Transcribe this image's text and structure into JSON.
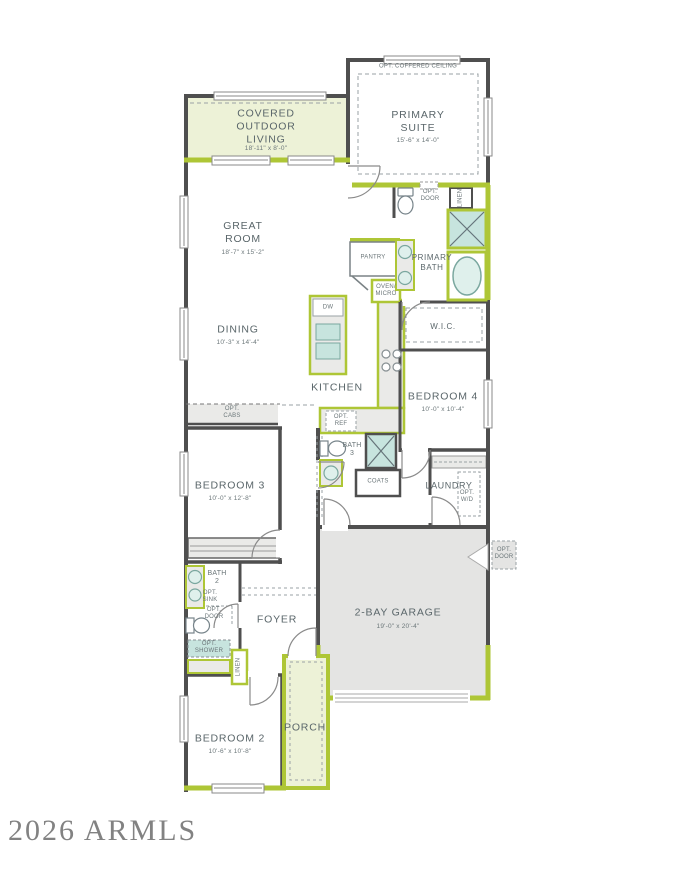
{
  "watermark": "2026 ARMLS",
  "colors": {
    "wall": "#4f4f4f",
    "accent_lime": "#aec636",
    "room_tint_green": "#edf2d7",
    "fixture_teal": "#c7e4de",
    "garage_fill": "#e4e4e3",
    "counter_fill": "#eaeae8",
    "label_text": "#5a666a",
    "watermark_text": "#828282"
  },
  "rooms": {
    "covered_outdoor_living": {
      "name": "COVERED\nOUTDOOR\nLIVING",
      "dims": "18'-11\" x 8'-0\""
    },
    "primary_suite": {
      "name": "PRIMARY\nSUITE",
      "dims": "15'-6\" x 14'-0\"",
      "option": "OPT. COFFERED CEILING"
    },
    "great_room": {
      "name": "GREAT\nROOM",
      "dims": "18'-7\" x 15'-2\""
    },
    "dining": {
      "name": "DINING",
      "dims": "10'-3\" x 14'-4\""
    },
    "kitchen": {
      "name": "KITCHEN"
    },
    "pantry": {
      "name": "PANTRY"
    },
    "primary_bath": {
      "name": "PRIMARY\nBATH"
    },
    "linen_primary": {
      "name": "LINEN"
    },
    "wic": {
      "name": "W.I.C."
    },
    "bedroom_4": {
      "name": "BEDROOM 4",
      "dims": "10'-0\" x 10'-4\""
    },
    "bath_3": {
      "name": "BATH\n3"
    },
    "coats": {
      "name": "COATS"
    },
    "laundry": {
      "name": "LAUNDRY"
    },
    "bedroom_3": {
      "name": "BEDROOM 3",
      "dims": "10'-0\" x 12'-8\""
    },
    "bath_2": {
      "name": "BATH\n2"
    },
    "linen_hall": {
      "name": "LINEN"
    },
    "foyer": {
      "name": "FOYER"
    },
    "garage": {
      "name": "2-BAY GARAGE",
      "dims": "19'-0\" x 20'-4\""
    },
    "bedroom_2": {
      "name": "BEDROOM 2",
      "dims": "10'-6\" x 10'-8\""
    },
    "porch": {
      "name": "PORCH"
    }
  },
  "annotations": {
    "opt_door_primary": "OPT.\nDOOR",
    "oven_micro": "OVEN/\nMICRO",
    "dw": "DW",
    "opt_cabs": "OPT.\nCABS",
    "opt_ref": "OPT.\nREF",
    "opt_wd": "OPT.\nW/D",
    "opt_sink": "OPT.\nSINK",
    "opt_door_bath2": "OPT.\nDOOR",
    "opt_shower": "OPT.\nSHOWER",
    "opt_door_garage": "OPT.\nDOOR"
  }
}
